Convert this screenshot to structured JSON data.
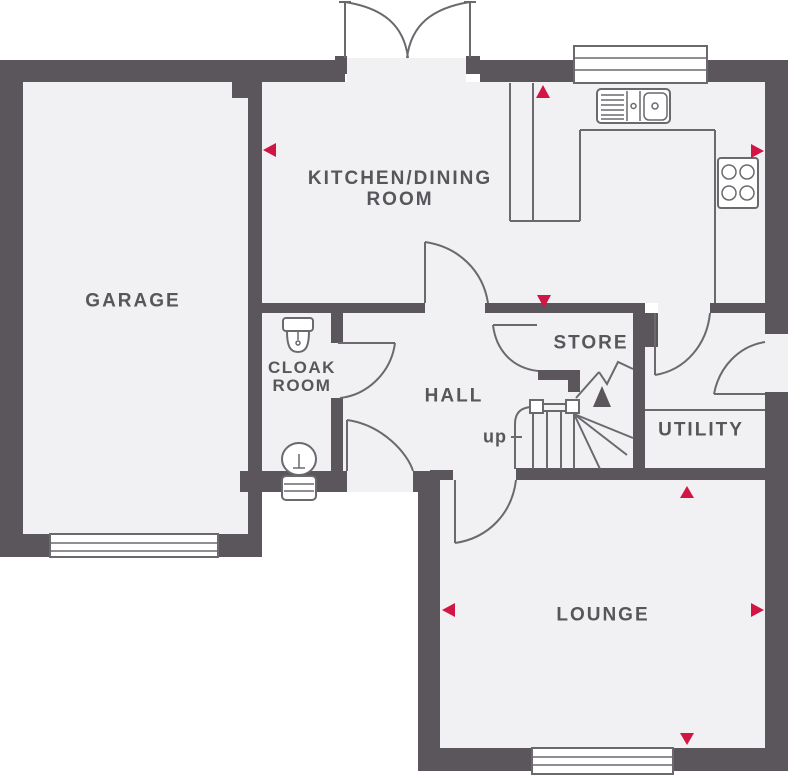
{
  "title": "Ground floor plan",
  "rooms": {
    "garage": {
      "label": "GARAGE"
    },
    "kitchen_dining": {
      "line1": "KITCHEN/DINING",
      "line2": "ROOM"
    },
    "cloakroom": {
      "line1": "CLOAK",
      "line2": "ROOM"
    },
    "hall": {
      "label": "HALL"
    },
    "store": {
      "label": "STORE"
    },
    "utility": {
      "label": "UTILITY"
    },
    "lounge": {
      "label": "LOUNGE"
    }
  },
  "stairs": {
    "direction_label": "up"
  },
  "fixtures": [
    "french-doors",
    "kitchen-window",
    "kitchen-sink",
    "kitchen-counter",
    "hob",
    "washbasin",
    "wc-toilet",
    "staircase",
    "garage-door",
    "lounge-window",
    "side-door"
  ],
  "markers": {
    "red_arrow_count": 8,
    "description": "red triangular markers on kitchen top/left/right walls, store wall, and lounge top/left/right/bottom walls"
  },
  "colors": {
    "wall": "#5a565b",
    "floor": "#f1f0f2",
    "line": "#6b696e",
    "label_text": "#57575b",
    "marker_red": "#d11544",
    "background": "#ffffff"
  }
}
